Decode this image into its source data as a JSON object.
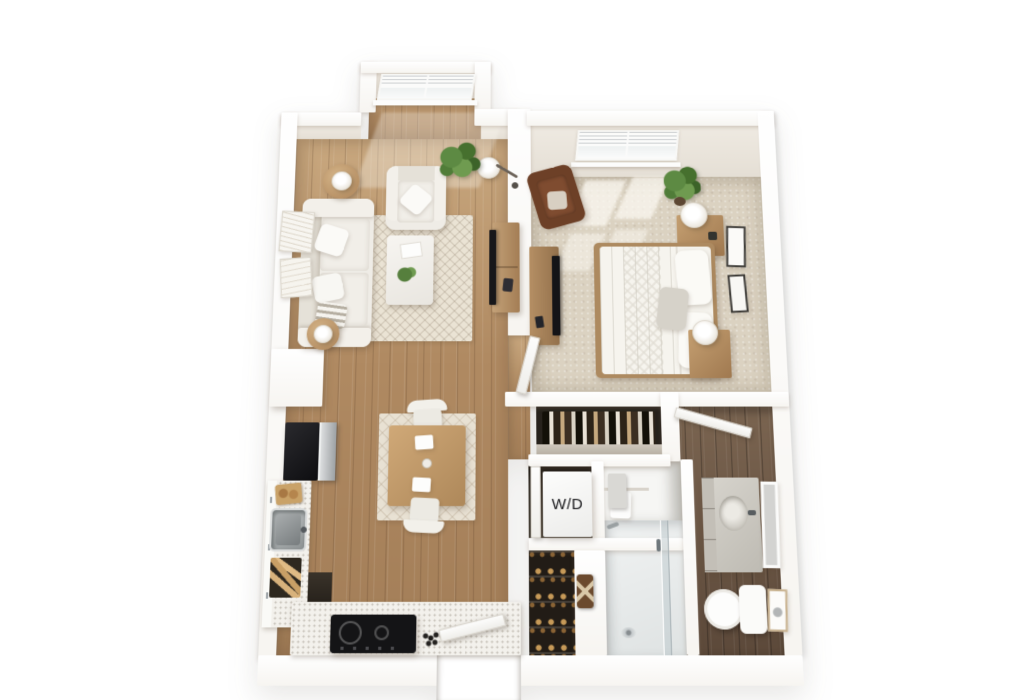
{
  "labels": {
    "washer_dryer": "W/D"
  },
  "palette": {
    "background": "#ffffff",
    "wall": "#ffffff",
    "wall_inner_face": "#eae5dd",
    "wood_floor": "#b28c66",
    "carpet": "#dbd2c1",
    "dark_wood_floor": "#6e5947",
    "counter_speckle": "#f3f1ec",
    "appliance_dark": "#1f1f22",
    "stainless": "#b9bcbd",
    "upholstery_white": "#f1eee9",
    "accent_chair_brown": "#77452e",
    "wood_furniture": "#b3906a",
    "rug_cream": "#eae3d4",
    "plant_green": "#5d8a43"
  },
  "scene": {
    "type": "3d-floorplan-render",
    "view": "top-down-perspective",
    "rooms": [
      {
        "name": "living-room",
        "floor": "light-wood",
        "items": [
          "bay-window",
          "sofa",
          "armchair",
          "coffee-table",
          "area-rug",
          "side-table-with-lamp",
          "second-side-table-with-lamp",
          "floor-lamp",
          "potted-plant",
          "tv-console",
          "leaning-wall-art"
        ]
      },
      {
        "name": "bedroom",
        "floor": "carpet",
        "items": [
          "window",
          "bed",
          "nightstand-with-lamp",
          "second-nightstand-with-lamp",
          "accent-chair",
          "dresser-with-tv",
          "potted-plant",
          "wall-art",
          "door"
        ]
      },
      {
        "name": "kitchen",
        "floor": "light-wood",
        "items": [
          "refrigerator",
          "sink",
          "cooktop",
          "l-shaped-counter",
          "lower-cabinets"
        ]
      },
      {
        "name": "dining-area",
        "floor": "light-wood",
        "items": [
          "dining-table",
          "dining-chair",
          "second-dining-chair",
          "area-rug"
        ]
      },
      {
        "name": "bathroom",
        "floor": "dark-wood",
        "items": [
          "vanity-sink",
          "leaning-mirror",
          "toilet",
          "walk-in-shower",
          "wall-art",
          "door"
        ]
      },
      {
        "name": "laundry-closet",
        "floor": "dark",
        "label_key": "washer_dryer",
        "items": [
          "stacked-washer-dryer",
          "closet-door"
        ]
      },
      {
        "name": "wardrobe-closet",
        "floor": "dark",
        "items": [
          "hanging-clothes-rod"
        ]
      },
      {
        "name": "linen-closet",
        "floor": "white",
        "items": [
          "shelf-with-box"
        ]
      },
      {
        "name": "shoe-closet",
        "floor": "dark",
        "items": [
          "shoe-shelves"
        ]
      },
      {
        "name": "entry",
        "items": [
          "entry-door",
          "porch-recess"
        ]
      }
    ]
  }
}
